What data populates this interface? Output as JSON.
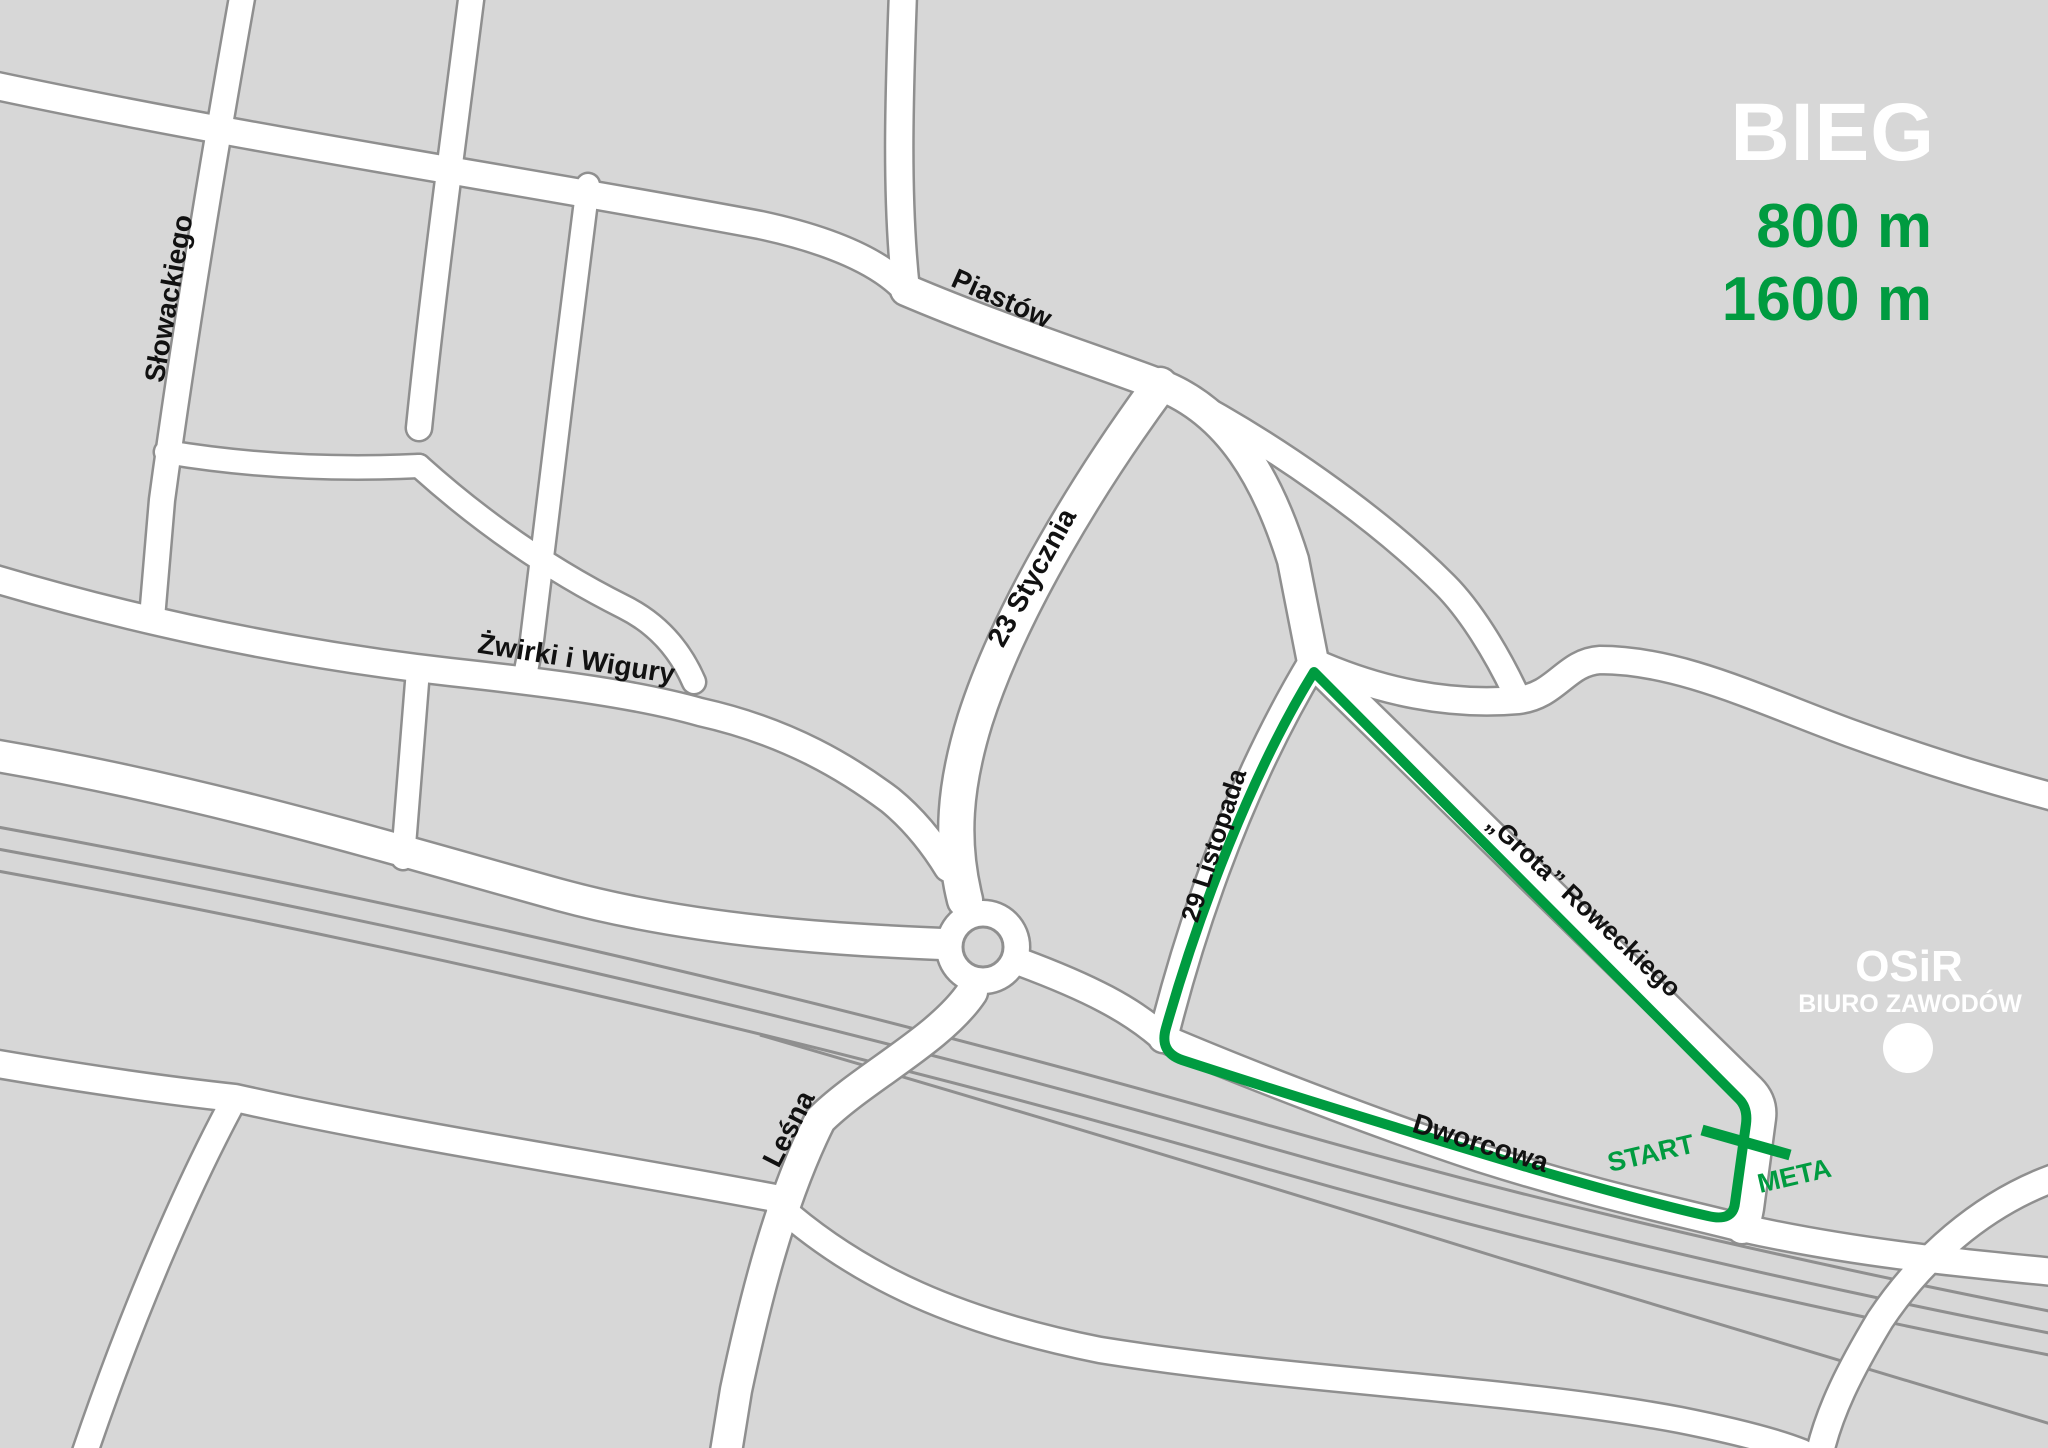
{
  "legend": {
    "title": "BIEG",
    "distances": [
      "800 m",
      "1600 m"
    ]
  },
  "streets": [
    {
      "id": "slowackiego",
      "name": "Słowackiego"
    },
    {
      "id": "zwirki-i-wigury",
      "name": "Żwirki i Wigury"
    },
    {
      "id": "piastow",
      "name": "Piastów"
    },
    {
      "id": "23-stycznia",
      "name": "23 Stycznia"
    },
    {
      "id": "lesna",
      "name": "Leśna"
    },
    {
      "id": "29-listopada",
      "name": "29 Listopada"
    },
    {
      "id": "grota-roweckiego",
      "name": "„Grota” Roweckiego"
    },
    {
      "id": "dworcowa",
      "name": "Dworcowa"
    }
  ],
  "route": {
    "start": "START",
    "finish": "META",
    "color": "#009b40"
  },
  "venue": {
    "name": "OSiR",
    "subtitle": "BIURO ZAWODÓW"
  },
  "colors": {
    "background": "#d7d7d7",
    "road_fill": "#ffffff",
    "road_casing": "#8f8f8f",
    "railway": "#8f8f8f",
    "route_green": "#009b40",
    "title_white": "#ffffff",
    "label_black": "#111111"
  }
}
